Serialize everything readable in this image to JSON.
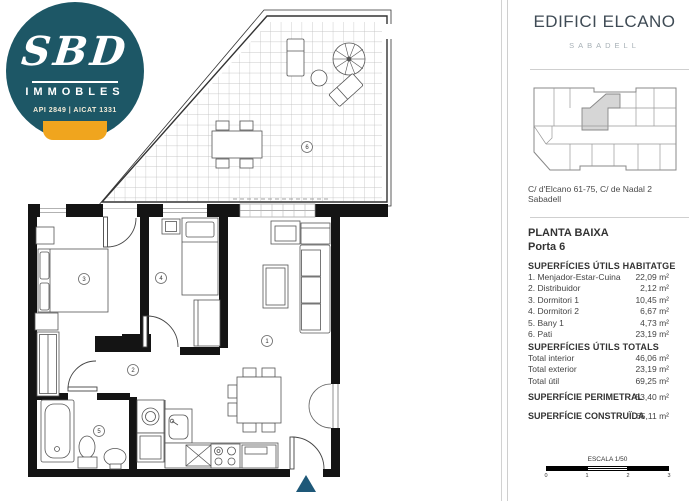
{
  "logo": {
    "brand": "SBD",
    "subtitle": "IMMOBLES",
    "credentials": "API 2849  |  AICAT 1331",
    "circle_color": "#1d5766",
    "accent_color": "#f0a51e"
  },
  "plan": {
    "room_labels": [
      "1",
      "2",
      "3",
      "4",
      "5",
      "6"
    ],
    "entrance_marker_color": "#1e5878"
  },
  "sidebar": {
    "title": "EDIFICI ELCANO",
    "subtitle": "SABADELL",
    "address_line1": "C/ d'Elcano 61-75, C/ de Nadal 2",
    "address_line2": "Sabadell",
    "floor": "PLANTA BAIXA",
    "door": "Porta 6",
    "habitatge": {
      "heading": "SUPERFÍCIES ÚTILS HABITATGE",
      "items": [
        {
          "label": "1. Menjador-Estar-Cuina",
          "value": "22,09 m²"
        },
        {
          "label": "2. Distribuidor",
          "value": "2,12 m²"
        },
        {
          "label": "3. Dormitori 1",
          "value": "10,45 m²"
        },
        {
          "label": "4. Dormitori 2",
          "value": "6,67 m²"
        },
        {
          "label": "5. Bany 1",
          "value": "4,73 m²"
        },
        {
          "label": "6. Pati",
          "value": "23,19 m²"
        }
      ]
    },
    "totals": {
      "heading": "SUPERFÍCIES ÚTILS TOTALS",
      "items": [
        {
          "label": "Total interior",
          "value": "46,06 m²"
        },
        {
          "label": "Total exterior",
          "value": "23,19 m²"
        },
        {
          "label": "Total útil",
          "value": "69,25 m²"
        }
      ]
    },
    "perimetral": {
      "label": "SUPERFÍCIE PERIMETRAL",
      "value": "53,40 m²"
    },
    "construida": {
      "label": "SUPERFÍCIE CONSTRUÏDA",
      "value": "65,11 m²"
    },
    "scale": {
      "label": "ESCALA 1/50",
      "ticks": [
        "0",
        "1",
        "2",
        "3"
      ]
    }
  }
}
